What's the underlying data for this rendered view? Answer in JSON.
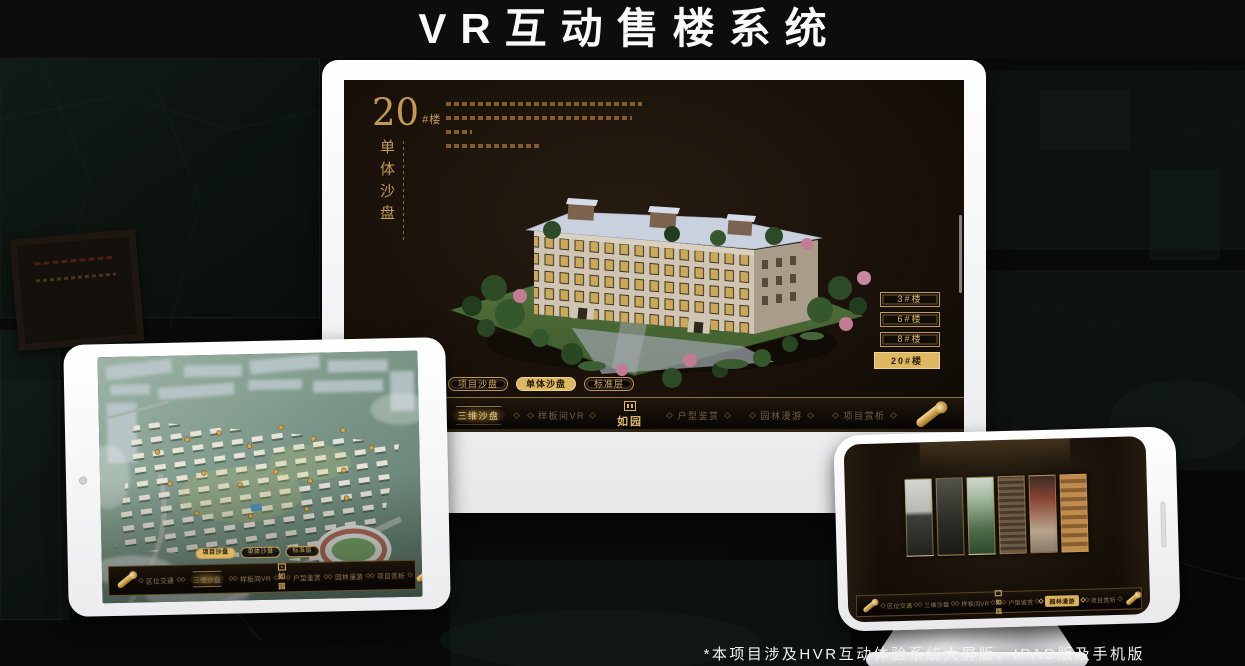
{
  "header": {
    "title": "VR互动售楼系统"
  },
  "footer": {
    "note": "*本项目涉及HVR互动体验系统大屏版、IPAD版及手机版"
  },
  "colors": {
    "gold": "#c9a55e",
    "gold_active_bg": "#ddb762",
    "screen_bg": "#1a120a",
    "device_shell": "#f2f2f4"
  },
  "monitor": {
    "screen_title": {
      "number": "20",
      "suffix": "#楼",
      "vertical": "单体沙盘"
    },
    "floor_buttons": [
      {
        "label": "3#楼",
        "active": false
      },
      {
        "label": "6#楼",
        "active": false
      },
      {
        "label": "8#楼",
        "active": false
      },
      {
        "label": "20#楼",
        "active": true
      }
    ],
    "sub_tabs": [
      {
        "label": "项目沙盘",
        "active": false
      },
      {
        "label": "单体沙盘",
        "active": true
      },
      {
        "label": "标准层",
        "active": false
      }
    ],
    "nav": {
      "items_left": [
        {
          "label": "区位交通",
          "active": false
        },
        {
          "label": "三维沙盘",
          "active": true
        },
        {
          "label": "样板间VR",
          "active": false
        }
      ],
      "logo": "如园",
      "items_right": [
        {
          "label": "户型鉴赏",
          "active": false
        },
        {
          "label": "园林漫游",
          "active": false
        },
        {
          "label": "项目赏析",
          "active": false
        }
      ]
    }
  },
  "tablet": {
    "sub_tabs": [
      {
        "label": "项目沙盘",
        "active": true
      },
      {
        "label": "单体沙盘",
        "active": false
      },
      {
        "label": "标准层",
        "active": false
      }
    ],
    "nav": {
      "items_left": [
        {
          "label": "区位交通",
          "active": false
        },
        {
          "label": "三维沙盘",
          "active": true
        },
        {
          "label": "样板间VR",
          "active": false
        }
      ],
      "logo": "如园",
      "items_right": [
        {
          "label": "户型鉴赏",
          "active": false
        },
        {
          "label": "园林漫游",
          "active": false
        },
        {
          "label": "项目赏析",
          "active": false
        }
      ]
    }
  },
  "phone": {
    "nav": {
      "items_left": [
        {
          "label": "区位交通",
          "active": false
        },
        {
          "label": "三维沙盘",
          "active": false
        },
        {
          "label": "样板间VR",
          "active": false
        }
      ],
      "logo": "如园",
      "items_right": [
        {
          "label": "户型鉴赏",
          "active": false
        },
        {
          "label": "园林漫游",
          "active": true
        },
        {
          "label": "项目赏析",
          "active": false
        }
      ]
    }
  }
}
